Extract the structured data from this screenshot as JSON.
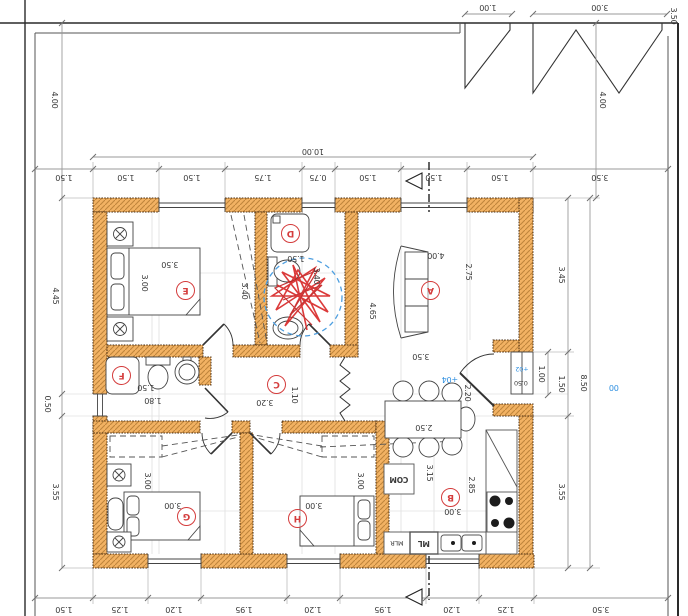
{
  "colors": {
    "wall_fill": "#F2B263",
    "wall_hatch": "#C0853C",
    "markup_red": "#D43C3C",
    "level_blue": "#2E8FE0"
  },
  "drawing": {
    "site": {
      "gate_small_width": "1.00",
      "gate_large_width": "3.00",
      "boundary_right": "3.50",
      "setback_left": "4.00",
      "setback_right": "4.00",
      "house_width_total": "10.00",
      "site_level": "00"
    },
    "dim_chains": {
      "top": [
        "1.50",
        "1.50",
        "1.50",
        "1.75",
        "0.75",
        "1.50",
        "1.50",
        "1.50",
        "3.50"
      ],
      "bottom": [
        "1.50",
        "1.25",
        "1.20",
        "1.95",
        "1.20",
        "1.95",
        "1.20",
        "1.25",
        "3.50"
      ],
      "left": [
        "4.45",
        "0.50",
        "3.55"
      ],
      "right": [
        "3.45",
        "1.50",
        "3.55"
      ],
      "right_overall": "8.50",
      "porch_width": "1.00"
    },
    "rooms": {
      "A": {
        "label": "A",
        "dim1": "4.00",
        "dim2": "2.75",
        "dim3": "4.65",
        "dim4": "3.50"
      },
      "B": {
        "label": "B",
        "dim1": "3.15",
        "dim2": "2.85",
        "dim3": "3.00",
        "table": "2.50"
      },
      "C": {
        "label": "C",
        "dim1": "3.20",
        "dim2": "1.10"
      },
      "D": {
        "label": "D",
        "dim1": "1.50",
        "dim2": "3.40"
      },
      "E": {
        "label": "E",
        "dim1": "3.50",
        "dim2": "3.00",
        "dim3": "3.40"
      },
      "F": {
        "label": "F",
        "dim1": "1.50",
        "dim2": "1.80"
      },
      "G": {
        "label": "G",
        "dim1": "3.00",
        "dim2": "3.00"
      },
      "H": {
        "label": "H",
        "dim1": "3.00",
        "dim2": "3.00"
      }
    },
    "entrance": {
      "level_inside": "+04",
      "level_step": "+02",
      "step_depth": "0.50",
      "door_width": "2.20"
    },
    "kitchen": {
      "fridge": "COM",
      "appliance_left": "MLR",
      "appliance_right": "ML"
    }
  }
}
